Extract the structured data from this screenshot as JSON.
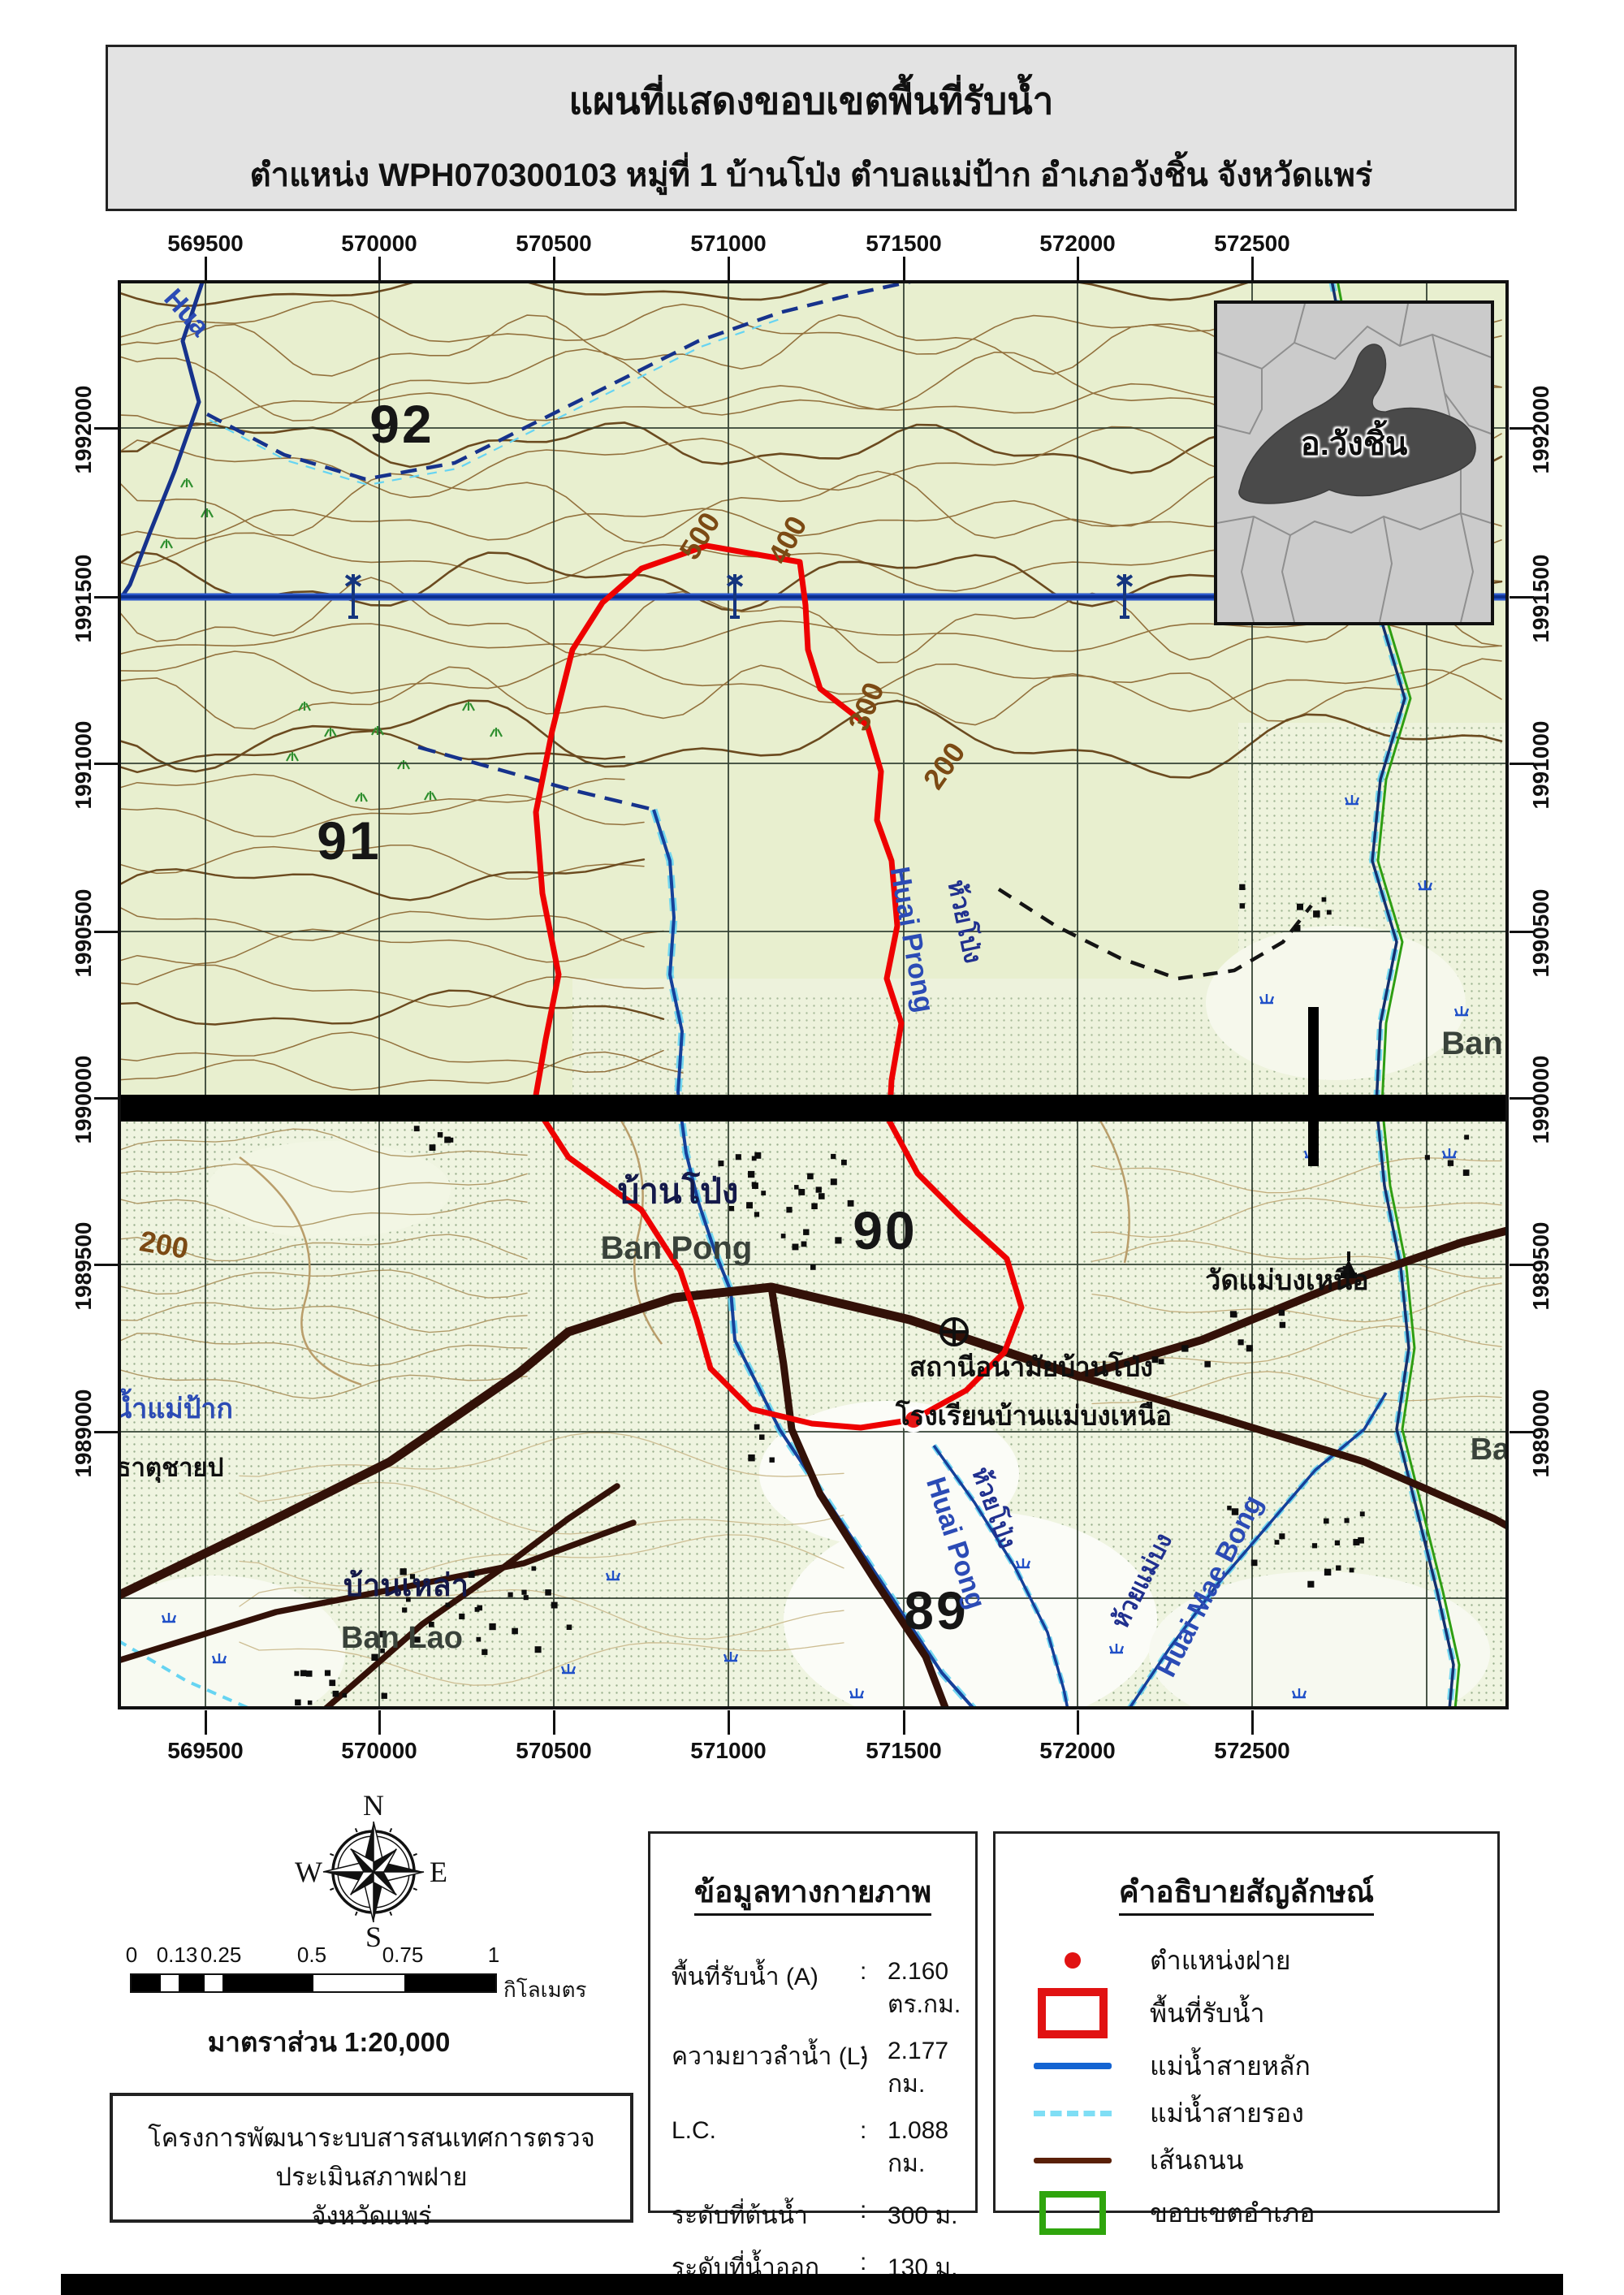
{
  "title": {
    "line1": "แผนที่แสดงขอบเขตพื้นที่รับน้ำ",
    "line2": "ตำแหน่ง WPH070300103 หมู่ที่ 1 บ้านโป่ง ตำบลแม่ป้าก อำเภอวังชิ้น จังหวัดแพร่"
  },
  "map": {
    "x_labels": [
      "569500",
      "570000",
      "570500",
      "571000",
      "571500",
      "572000",
      "572500"
    ],
    "y_labels": [
      "1992000",
      "1991500",
      "1991000",
      "1990500",
      "1990000",
      "1989500",
      "1989000"
    ],
    "grid_numbers": {
      "n92": "92",
      "n91": "91",
      "n90": "90",
      "n89": "89"
    },
    "contour_labels": {
      "c500": "500",
      "c400": "400",
      "c300": "300",
      "c200a": "200",
      "c200b": "200"
    },
    "labels": {
      "hua": "Hua",
      "ban_pong_th": "บ้านโป่ง",
      "ban_pong_en": "Ban Pong",
      "ban_lao_th": "บ้านเหล่า",
      "ban_lao_en": "Ban Lao",
      "huai_prong_en": "Huai Prong",
      "huai_prong_th": "ห้วยโป่ง",
      "huai_pong_en": "Huai Pong",
      "huai_pong_th": "ห้วยโป่ง",
      "huai_mae_bong_en": "Huai Mae Bong",
      "huai_mae_bong_th": "ห้วยแม่บง",
      "nam_mae_pak": "น้ำแม่ป้าก",
      "that_note": "ธาตุชายป",
      "health_station": "สถานีอนามัยบ้านโป่ง",
      "school": "โรงเรียนบ้านแม่บงเหนือ",
      "temple": "วัดแม่บงเหนือ",
      "ban_right": "Ban",
      "ba_right": "Ba"
    },
    "inset_label": "อ.วังชิ้น"
  },
  "compass": {
    "n": "N",
    "e": "E",
    "s": "S",
    "w": "W"
  },
  "scalebar": {
    "ticks": [
      "0",
      "0.13",
      "0.25",
      "0.5",
      "0.75",
      "1"
    ],
    "unit": "กิโลเมตร",
    "scale_text": "มาตราส่วน  1:20,000"
  },
  "info": {
    "title": "ข้อมูลทางกายภาพ",
    "rows": [
      {
        "label": "พื้นที่รับน้ำ (A)",
        "colon": ":",
        "value": "2.160 ตร.กม."
      },
      {
        "label": "ความยาวลำน้ำ (L)",
        "colon": ":",
        "value": "2.177 กม."
      },
      {
        "label": "L.C.",
        "colon": ":",
        "value": "1.088 กม."
      },
      {
        "label": "ระดับที่ต้นน้ำ",
        "colon": ":",
        "value": "300 ม."
      },
      {
        "label": "ระดับที่น้ำออก",
        "colon": ":",
        "value": "130 ม."
      },
      {
        "label": "ค่าต่างระดับความสูง (H)",
        "colon": ":",
        "value": "170 ม."
      },
      {
        "label": "ความลาดชัน (S)",
        "colon": ":",
        "value": "0.0781"
      }
    ]
  },
  "legend": {
    "title": "คำอธิบายสัญลักษณ์",
    "items": [
      {
        "label": "ตำแหน่งฝาย"
      },
      {
        "label": "พื้นที่รับน้ำ"
      },
      {
        "label": "แม่น้ำสายหลัก"
      },
      {
        "label": "แม่น้ำสายรอง"
      },
      {
        "label": "เส้นถนน"
      },
      {
        "label": "ขอบเขตอำเภอ"
      }
    ]
  },
  "project": {
    "line1": "โครงการพัฒนาระบบสารสนเทศการตรวจประเมินสภาพฝาย",
    "line2": "จังหวัดแพร่"
  },
  "colors": {
    "boundary_red": "#ee0101",
    "river_blue": "#1464d2",
    "stream_cyan": "#7fdef5",
    "road_brown": "#331108",
    "district_green": "#2fa50d",
    "map_bg": "#e8efcf"
  }
}
